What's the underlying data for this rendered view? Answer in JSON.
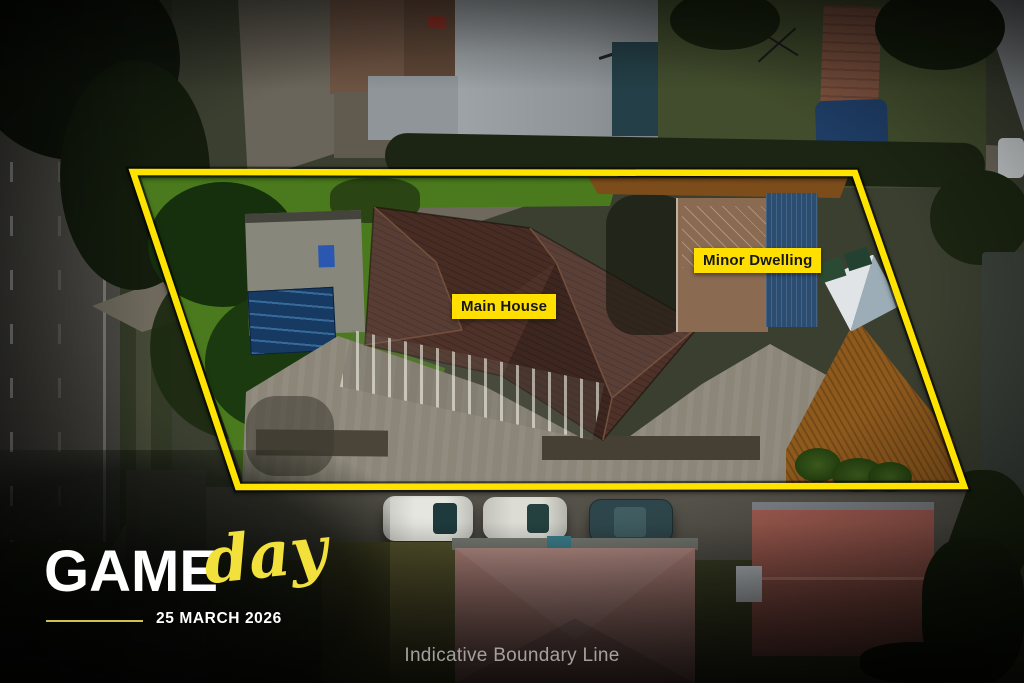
{
  "overlay": {
    "main_house_label": "Main House",
    "minor_dwelling_label": "Minor Dwelling",
    "footer_note": "Indicative Boundary Line",
    "accent_yellow": "#ffdf00",
    "boundary_line_color": "#ffe300"
  },
  "logo": {
    "word_block": "GAME",
    "word_script": "day",
    "event_date": "25 MARCH 2026",
    "script_yellow": "#f2e13c"
  }
}
